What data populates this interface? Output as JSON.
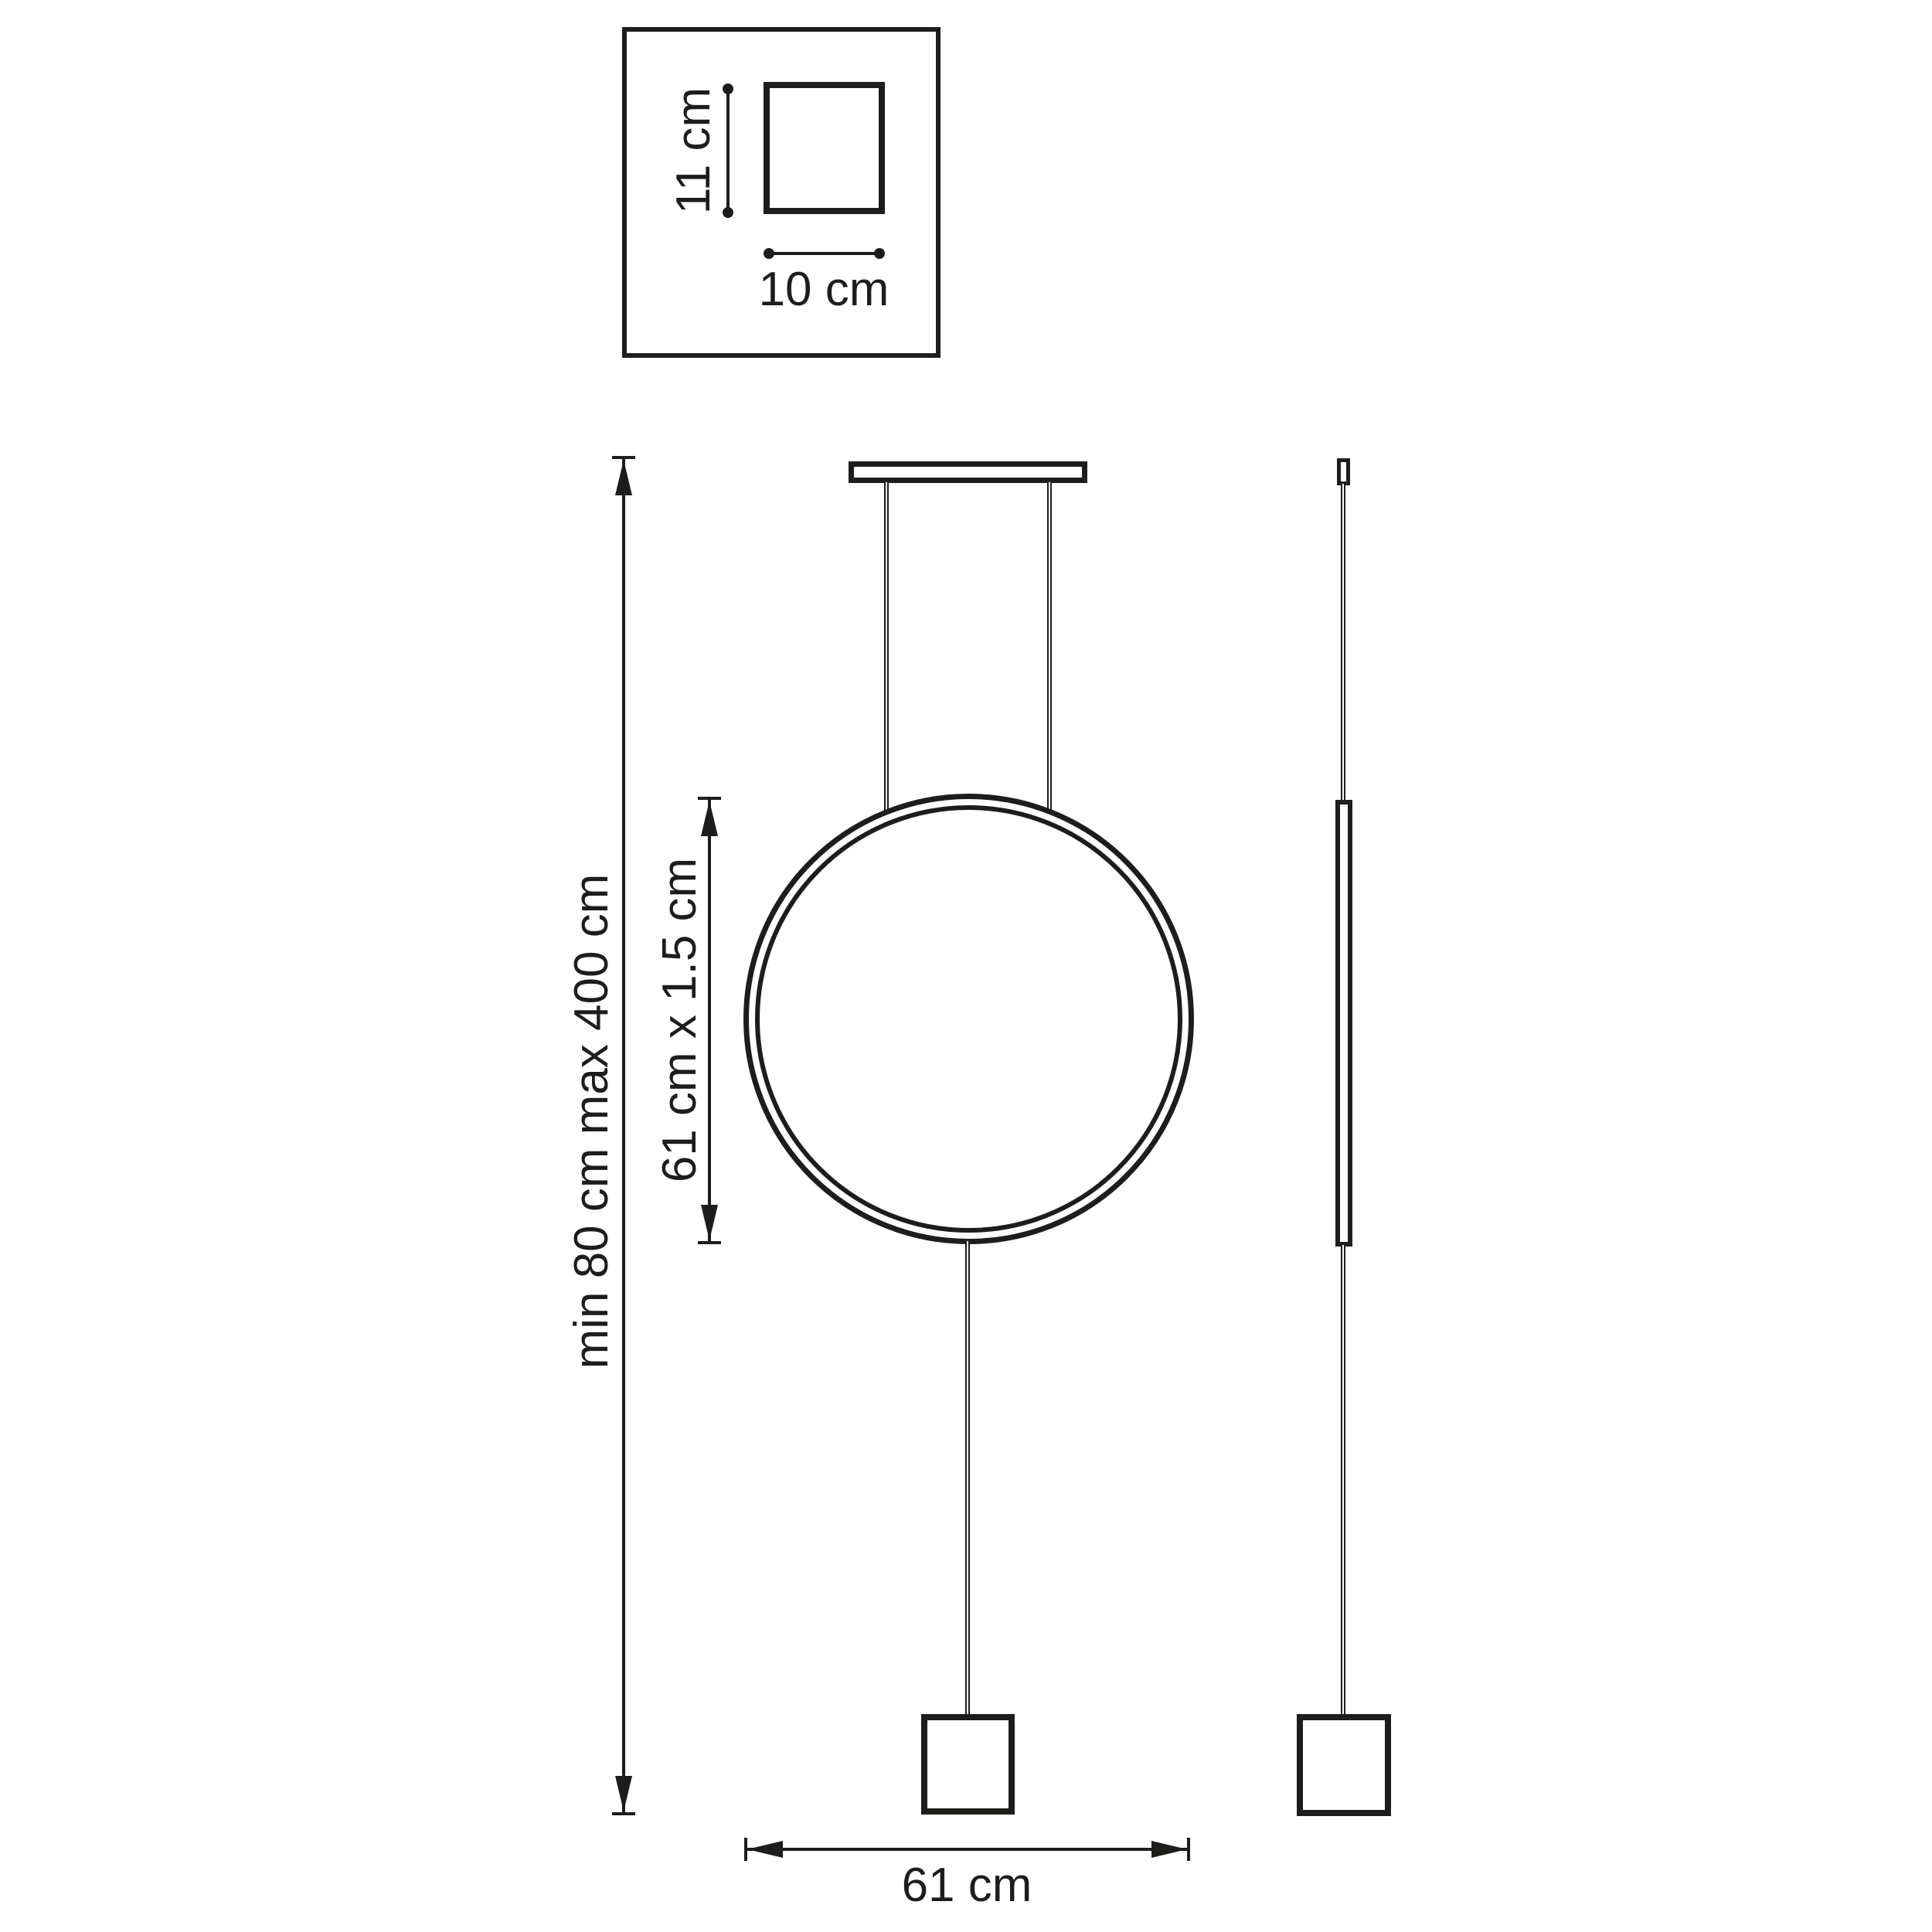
{
  "diagram": {
    "background": "#ffffff",
    "line_color": "#1d1d1b",
    "canopy_detail": {
      "height_label": "11 cm",
      "width_label": "10 cm"
    },
    "front_view": {
      "suspension_height_label": "min 80 cm max 400 cm",
      "ring_size_label": "61 cm x 1.5 cm",
      "overall_width_label": "61 cm"
    }
  }
}
